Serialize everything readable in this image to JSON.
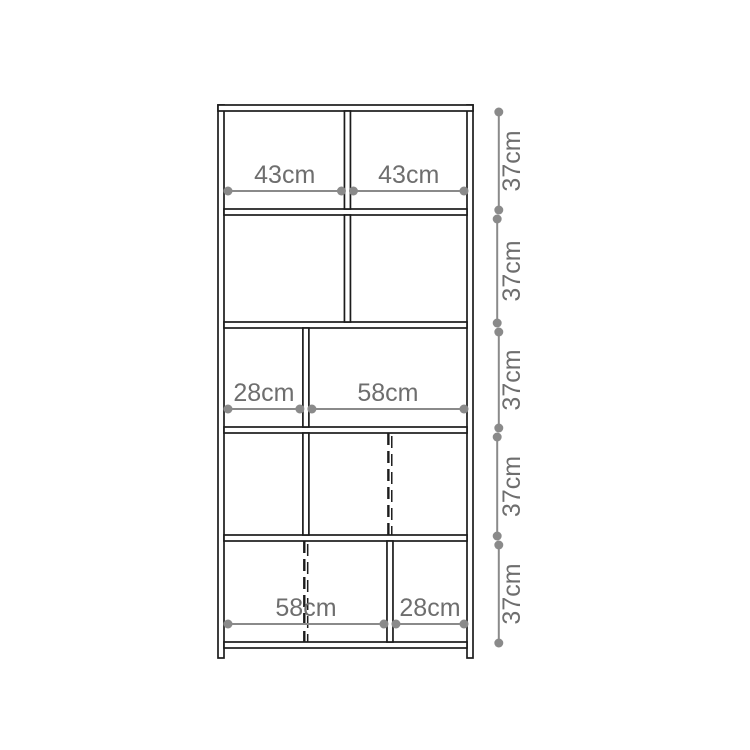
{
  "diagram": {
    "type": "furniture-dimension-diagram",
    "subject": "shelving-unit-front-elevation",
    "colors": {
      "background": "#ffffff",
      "structure_line": "#1c1c1c",
      "dimension_line": "#8a8a8a",
      "dimension_dot": "#8a8a8a",
      "dimension_text": "#6e6e6e"
    },
    "rows": [
      {
        "row": 1,
        "height_label": "37cm",
        "divider_frac": 0.508,
        "dashed_frac": null,
        "compartments": [
          {
            "width_label": "43cm"
          },
          {
            "width_label": "43cm"
          }
        ]
      },
      {
        "row": 2,
        "height_label": "37cm",
        "divider_frac": 0.508,
        "dashed_frac": null,
        "compartments": [
          {
            "width_label": ""
          },
          {
            "width_label": ""
          }
        ]
      },
      {
        "row": 3,
        "height_label": "37cm",
        "divider_frac": 0.337,
        "dashed_frac": null,
        "compartments": [
          {
            "width_label": "28cm"
          },
          {
            "width_label": "58cm"
          }
        ]
      },
      {
        "row": 4,
        "height_label": "37cm",
        "divider_frac": 0.337,
        "dashed_frac": 0.683,
        "compartments": [
          {
            "width_label": ""
          },
          {
            "width_label": ""
          }
        ]
      },
      {
        "row": 5,
        "height_label": "37cm",
        "divider_frac": 0.683,
        "dashed_frac": 0.337,
        "compartments": [
          {
            "width_label": "58cm"
          },
          {
            "width_label": "28cm"
          }
        ]
      }
    ]
  }
}
